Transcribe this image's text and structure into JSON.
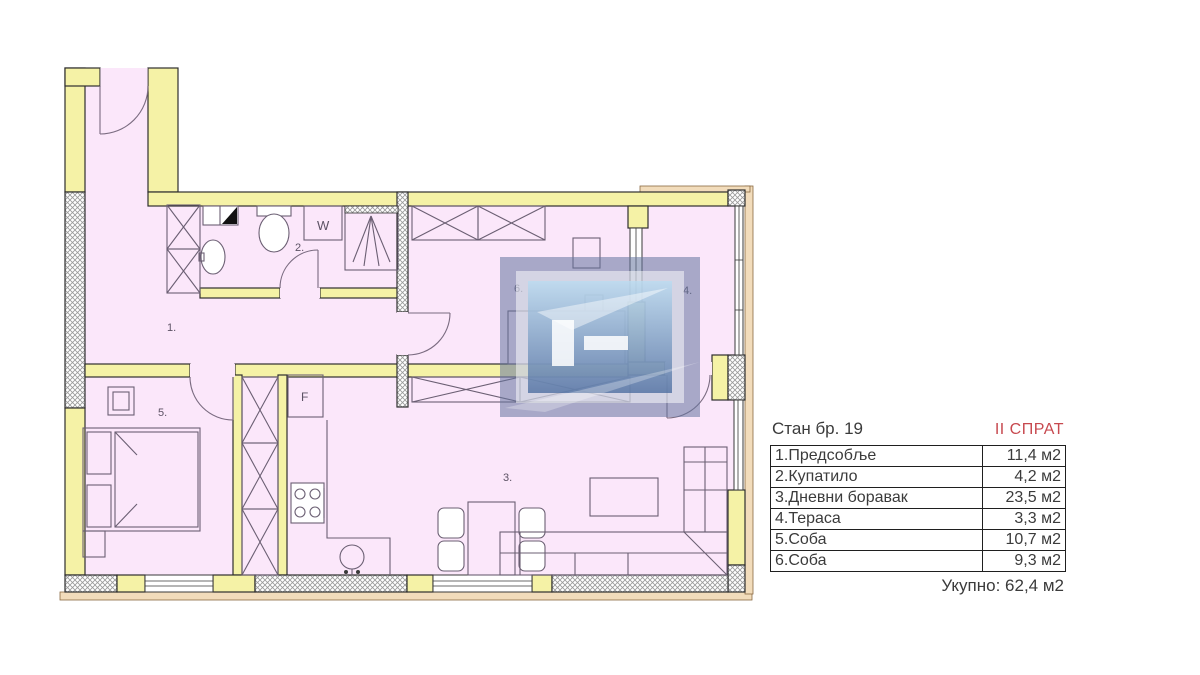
{
  "summary": {
    "unit_title": "Стан бр. 19",
    "floor_label": "II СПРАТ",
    "rows": [
      {
        "name": "1.Предсобље",
        "area": "11,4 м2"
      },
      {
        "name": "2.Купатило",
        "area": "4,2 м2"
      },
      {
        "name": "3.Дневни боравак",
        "area": "23,5 м2"
      },
      {
        "name": "4.Тераса",
        "area": "3,3 м2"
      },
      {
        "name": "5.Соба",
        "area": "10,7 м2"
      },
      {
        "name": "6.Соба",
        "area": "9,3 м2"
      }
    ],
    "total": "Укупно: 62,4 м2"
  },
  "plan": {
    "room_labels": {
      "hallway": "1.",
      "bathroom": "2.",
      "living_room": "3.",
      "terrace": "4.",
      "bedroom_5": "5.",
      "bedroom_6": "6."
    },
    "appliance_labels": {
      "washing_machine": "W",
      "fridge": "F"
    },
    "colors": {
      "floor_pink": "#fbe7fa",
      "wall_yellow": "#f5f2a6",
      "facade_tan": "#f2dcbb",
      "outline": "#2e2e2e",
      "furniture_line": "#6b5f73",
      "floor_label_red": "#c7494f",
      "watermark_blue": "#64759f"
    }
  }
}
